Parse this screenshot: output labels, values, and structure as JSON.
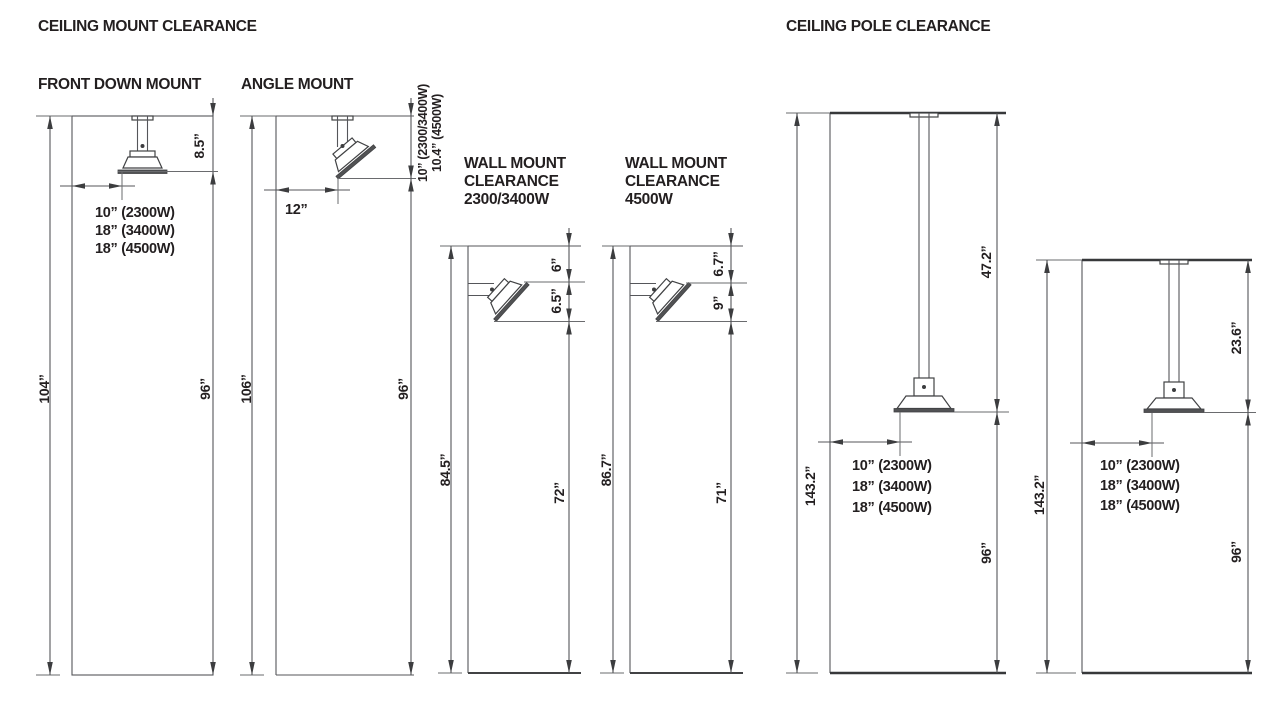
{
  "palette": {
    "text": "#231f20",
    "line": "#55565a",
    "thick_line": "#37383a"
  },
  "headers": {
    "ceiling_mount": "CEILING MOUNT CLEARANCE",
    "ceiling_pole": "CEILING POLE CLEARANCE"
  },
  "front_down": {
    "title": "FRONT DOWN MOUNT",
    "ceiling_height": "104”",
    "floor_to_heater": "96”",
    "heater_drop": "8.5”",
    "wall_offsets": [
      "10” (2300W)",
      "18” (3400W)",
      "18” (4500W)"
    ]
  },
  "angle": {
    "title": "ANGLE MOUNT",
    "ceiling_height": "106”",
    "floor_to_heater": "96”",
    "heater_drop_2300_3400": "10” (2300/3400W)",
    "heater_drop_4500": "10.4” (4500W)",
    "wall_offset": "12”"
  },
  "wall_2300_3400": {
    "title": [
      "WALL MOUNT",
      "CLEARANCE",
      "2300/3400W"
    ],
    "ceiling_height": "84.5”",
    "floor_to_heater": "72”",
    "ceiling_gap": "6”",
    "heater_height": "6.5”"
  },
  "wall_4500": {
    "title": [
      "WALL MOUNT",
      "CLEARANCE",
      "4500W"
    ],
    "ceiling_height": "86.7”",
    "floor_to_heater": "71”",
    "ceiling_gap": "6.7”",
    "heater_height": "9”"
  },
  "pole_long": {
    "ceiling_height": "143.2”",
    "pole_drop": "47.2”",
    "floor_to_heater": "96”",
    "wall_offsets": [
      "10” (2300W)",
      "18” (3400W)",
      "18” (4500W)"
    ]
  },
  "pole_short": {
    "ceiling_height": "143.2”",
    "pole_drop": "23.6”",
    "floor_to_heater": "96”",
    "wall_offsets": [
      "10” (2300W)",
      "18” (3400W)",
      "18” (4500W)"
    ]
  }
}
